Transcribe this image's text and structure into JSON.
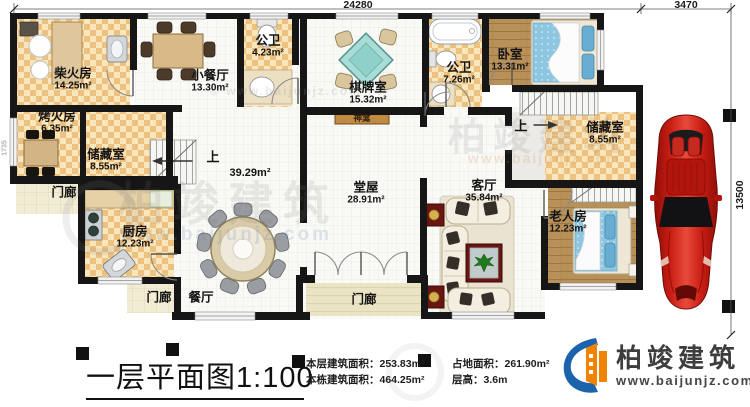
{
  "title": {
    "text": "一层平面图",
    "scale": "1:100"
  },
  "stats": [
    {
      "label": "本层建筑面积：",
      "value": "253.83m²"
    },
    {
      "label": "本栋建筑面积：",
      "value": "464.25m²"
    },
    {
      "label": "占地面积：",
      "value": "261.90m²"
    },
    {
      "label": "层高：",
      "value": "3.6m"
    }
  ],
  "dimensions": {
    "width_main": "24280",
    "width_carport": "3470",
    "depth": "13500",
    "side": "1735"
  },
  "rooms": {
    "firewood": {
      "name": "柴火房",
      "area": "14.25m²"
    },
    "bakehouse": {
      "name": "烤火房",
      "area": "6.35m²"
    },
    "storage_left": {
      "name": "储藏室",
      "area": "8.55m²"
    },
    "small_dining": {
      "name": "小餐厅",
      "area": "13.30m²"
    },
    "bath_small": {
      "name": "公卫",
      "area": "4.23m²"
    },
    "mahjong": {
      "name": "棋牌室",
      "area": "15.32m²"
    },
    "bath_main": {
      "name": "公卫",
      "area": "7.26m²"
    },
    "bedroom": {
      "name": "卧室",
      "area": "13.31m²"
    },
    "storage_right": {
      "name": "储藏室",
      "area": "8.55m²"
    },
    "elder": {
      "name": "老人房",
      "area": "12.23m²"
    },
    "living": {
      "name": "客厅",
      "area": "35.84m²"
    },
    "main_hall": {
      "name": "堂屋",
      "area": "28.91m²"
    },
    "kitchen": {
      "name": "厨房",
      "area": "12.23m²"
    },
    "dining": {
      "name": "餐厅"
    },
    "stair_hall": {
      "area": "39.29m²"
    }
  },
  "labels": {
    "porch": "门廊",
    "shrine": "神龛",
    "up": "上"
  },
  "logo": {
    "brand": "柏竣建筑",
    "website": "www.baijunjz.com"
  },
  "watermark": {
    "brand": "柏竣建筑",
    "website": "www.baijunjz.com",
    "copy": "© www.baijunjz.com"
  },
  "colors": {
    "wall": "#161616",
    "checker": "#edc17f",
    "wood": "#b8905a",
    "car_red": "#c4160f",
    "logo_blue": "#1c63ad",
    "logo_orange": "#f08300"
  }
}
